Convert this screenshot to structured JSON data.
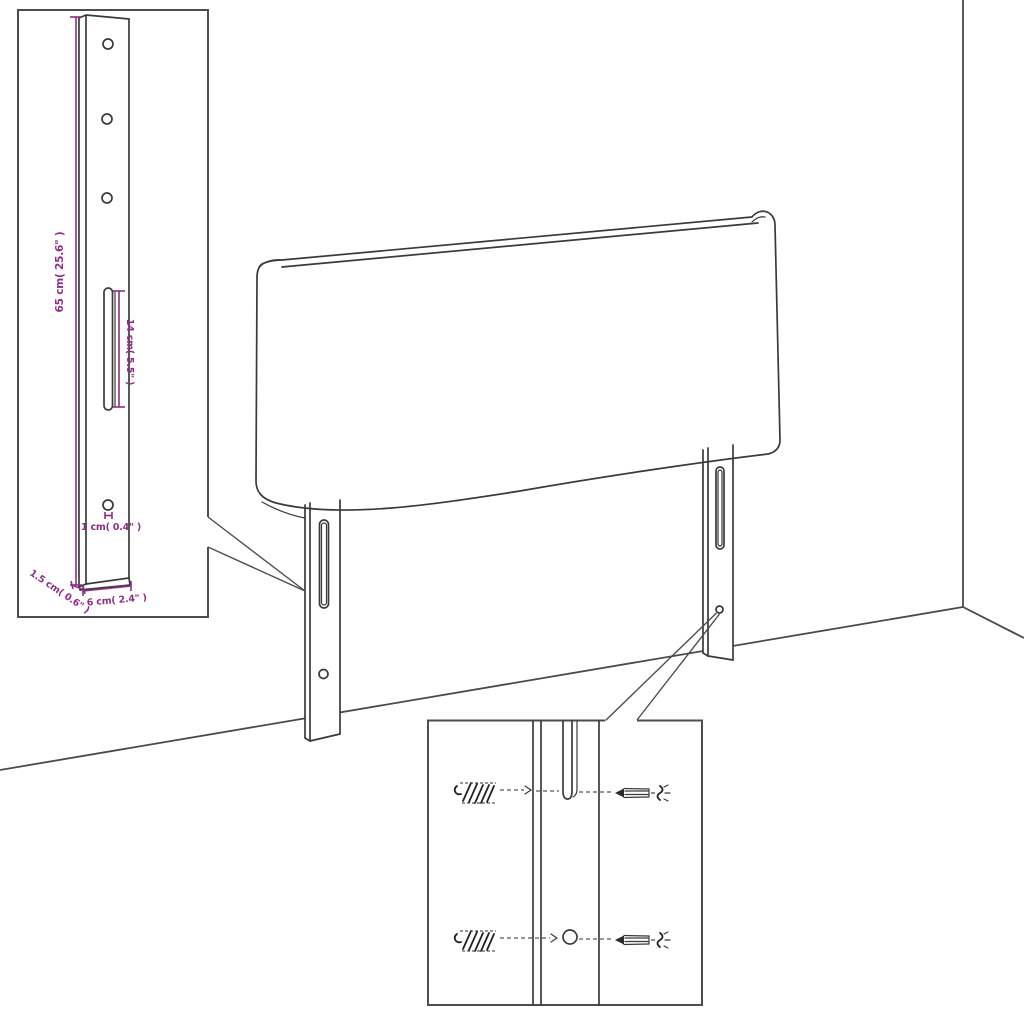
{
  "title": "Headboard mounting and dimensions diagram",
  "dimension_labels": {
    "bracket_height": "65 cm( 25.6\" )",
    "slot_length": "14 cm( 5.5\" )",
    "hole_diameter": "1 cm( 0.4\" )",
    "bracket_thickness": "1.5 cm( 0.6\" )",
    "bracket_width": "6 cm( 2.4\" )"
  },
  "colors": {
    "dimension_annotation": "#8e2d87",
    "outline": "#3a3a3a",
    "inset_border": "#4d4d4d",
    "background": "#ffffff"
  }
}
